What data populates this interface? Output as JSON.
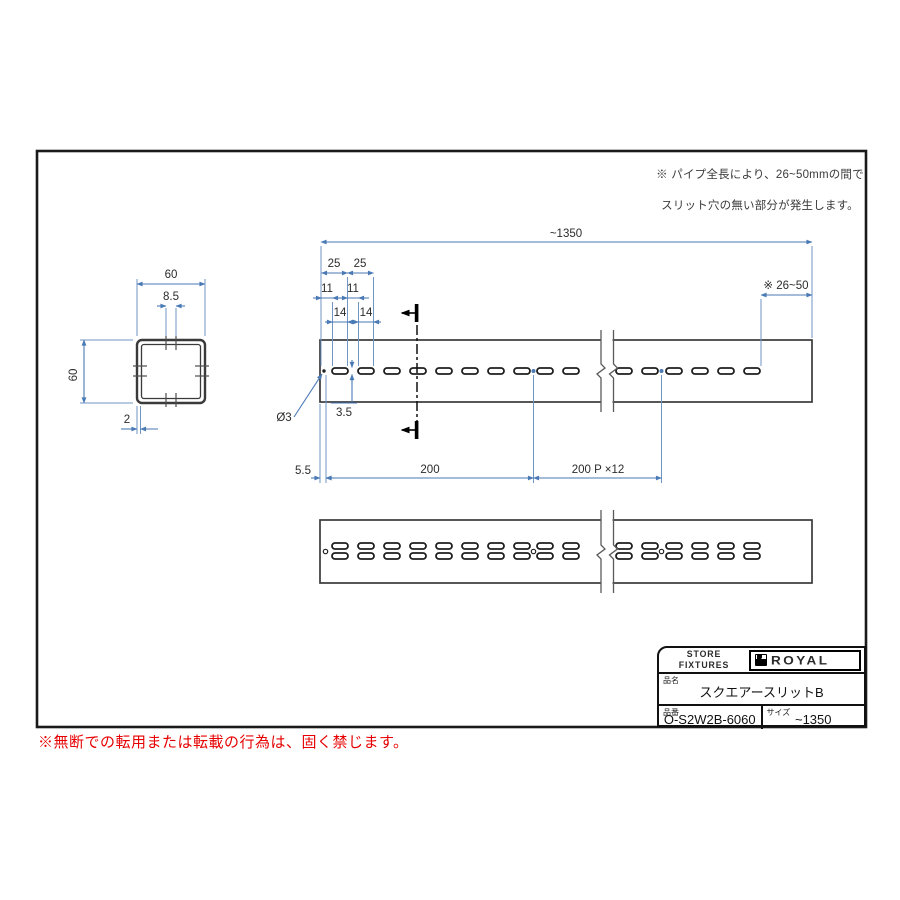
{
  "note": {
    "line1": "※ パイプ全長により、26~50mmの間で",
    "line2": "スリット穴の無い部分が発生します。"
  },
  "dims": {
    "overall": "~1350",
    "pitch25": [
      "25",
      "25"
    ],
    "gap11": [
      "11",
      "11"
    ],
    "len14": [
      "14",
      "14"
    ],
    "end_blank": "※ 26~50",
    "hole_dia": "Ø3",
    "slit_height": "3.5",
    "end_offset": "5.5",
    "first_pitch": "200",
    "pitch_series": "200 P ×12",
    "section_width": "60",
    "section_height": "60",
    "slit_width": "8.5",
    "wall_thickness": "2"
  },
  "title_block": {
    "header": "STORE FIXTURES",
    "brand": "ROYAL",
    "name_label": "品名",
    "name_value": "スクエアースリットB",
    "part_label": "品番",
    "part_value": "O-S2W2B-6060",
    "size_label": "サイズ",
    "size_value": "~1350"
  },
  "footer": {
    "warning": "※無断での転用または転載の行為は、固く禁じます。"
  },
  "colors": {
    "dimension_blue": "#4a7ab5",
    "drawing_line": "#3a3a3a",
    "warning_red": "#e60000"
  }
}
